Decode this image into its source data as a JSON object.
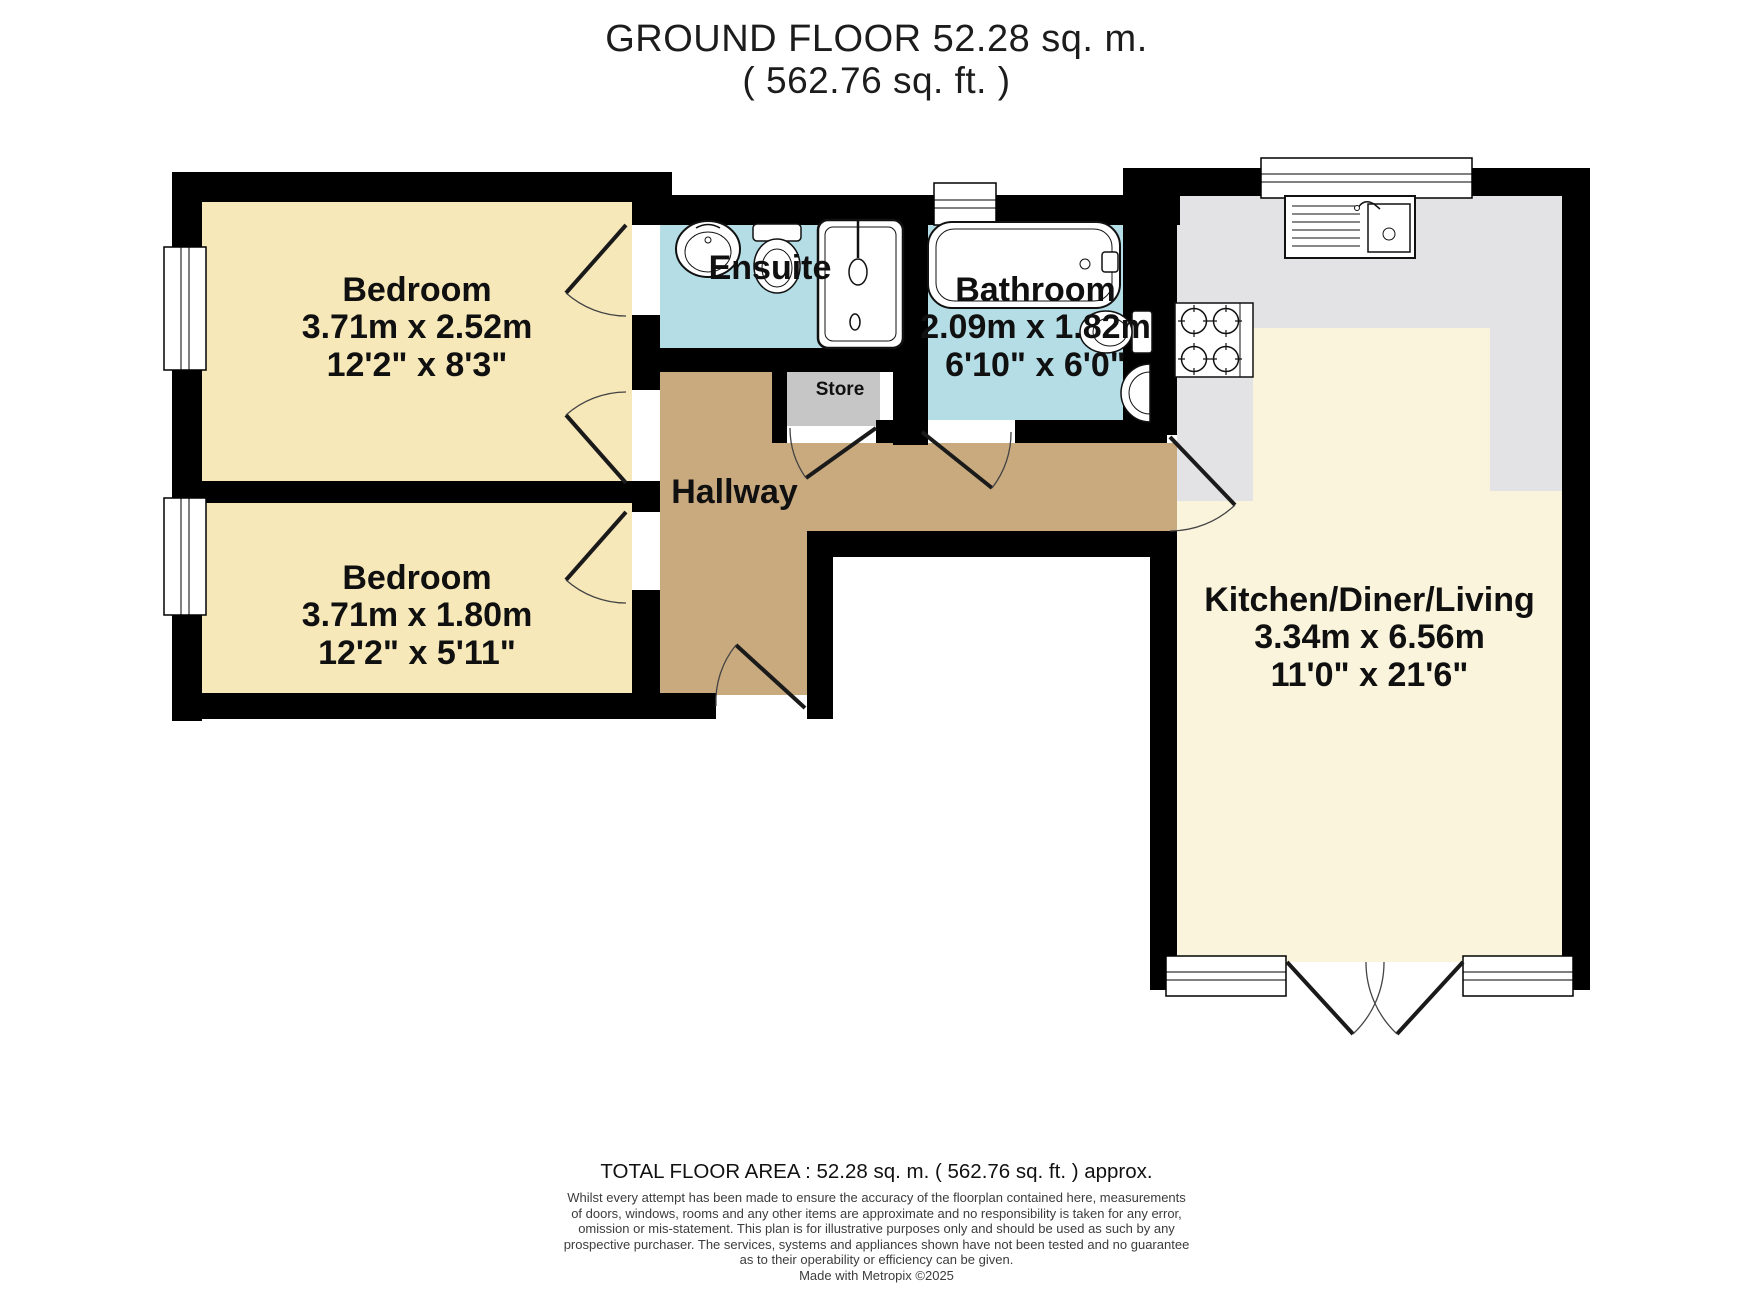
{
  "title": {
    "floor_label_and_area": "GROUND FLOOR 52.28 sq. m.",
    "area_ft": "( 562.76 sq. ft. )"
  },
  "rooms": {
    "bedroom_top": {
      "name": "Bedroom",
      "metric": "3.71m x 2.52m",
      "imperial": "12'2\" x 8'3\""
    },
    "bedroom_bottom": {
      "name": "Bedroom",
      "metric": "3.71m x 1.80m",
      "imperial": "12'2\" x 5'11\""
    },
    "ensuite": {
      "name": "Ensuite"
    },
    "bathroom": {
      "name": "Bathroom",
      "metric": "2.09m x 1.82m",
      "imperial": "6'10\" x 6'0\""
    },
    "hallway": {
      "name": "Hallway"
    },
    "store": {
      "name": "Store"
    },
    "kitchen_diner_living": {
      "name": "Kitchen/Diner/Living",
      "metric": "3.34m x 6.56m",
      "imperial": "11'0\" x 21'6\""
    }
  },
  "footer": {
    "total_area_line": "TOTAL FLOOR AREA : 52.28 sq. m. ( 562.76 sq. ft. ) approx.",
    "disclaimer_lines": [
      "Whilst every attempt has been made to ensure the accuracy of the floorplan contained here, measurements",
      "of doors, windows, rooms and any other items are approximate and no responsibility is taken for any error,",
      "omission or mis-statement. This plan is for illustrative purposes only and should be used as such by any",
      "prospective purchaser. The services, systems and appliances shown have not been tested and no guarantee",
      "as to their operability or efficiency can be given."
    ],
    "credit_line": "Made with Metropix ©2025"
  },
  "colors": {
    "wall": "#000000",
    "bedroom_floor": "#F6E8B9",
    "kitchen_floor": "#FAF4DC",
    "wet_room_floor": "#B5DDE6",
    "hallway_floor": "#C9A97E",
    "store_floor": "#C6C6C6",
    "counter": "#E3E3E5"
  }
}
